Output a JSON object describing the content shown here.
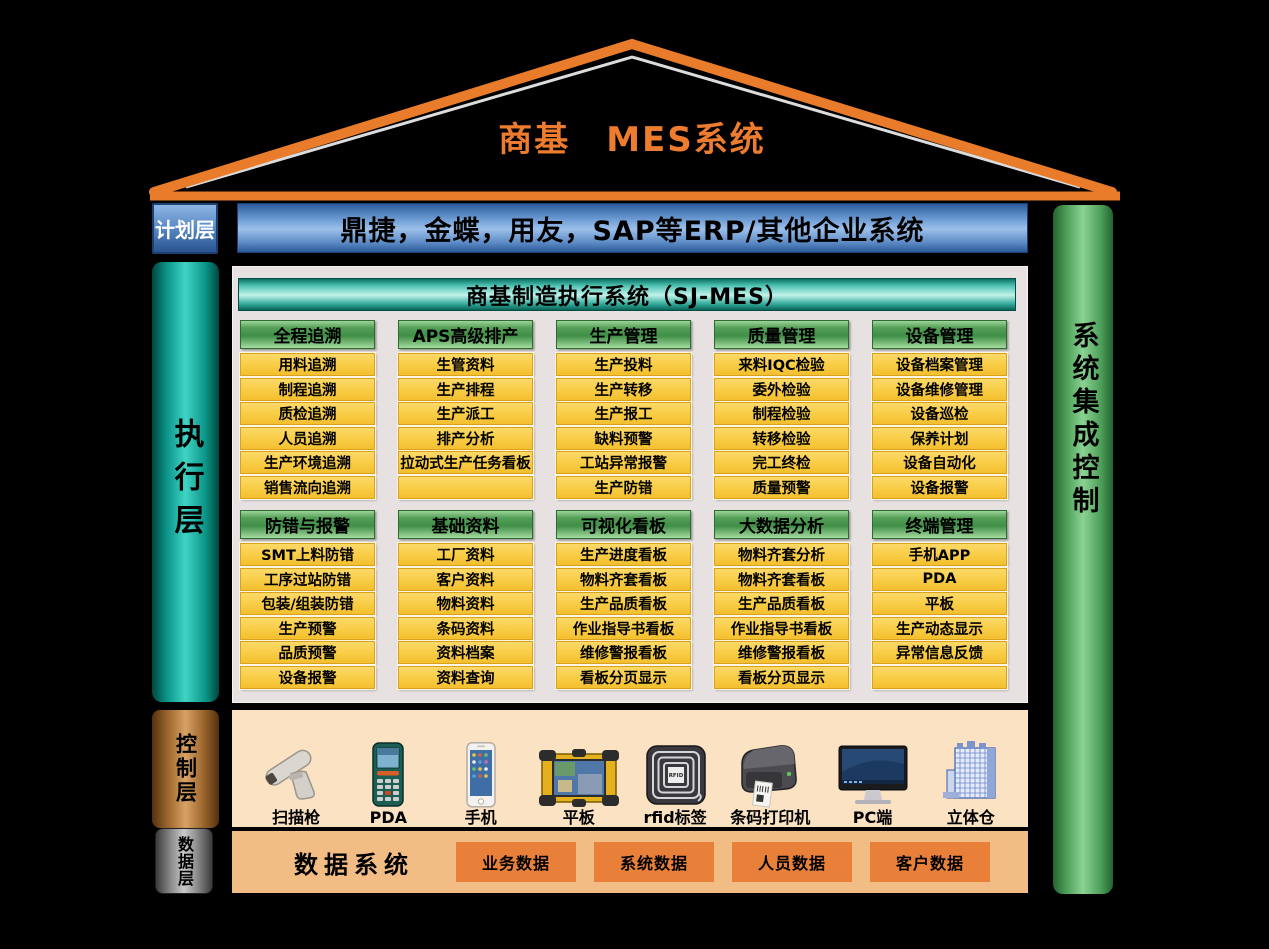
{
  "colors": {
    "roof_orange": "#e87c2a",
    "title_orange": "#ed7c2f",
    "erp_blue": "#5d8cc6",
    "execution_teal": "#3fd4c4",
    "module_header_green": "#3f8f46",
    "module_item_yellow": "#f8cc45",
    "control_copper": "#d8a265",
    "control_panel_peach": "#fbe2c3",
    "data_panel_orange": "#f2bc85",
    "data_box_orange": "#e8803a",
    "integration_green": "#8bd393"
  },
  "roof": {
    "title": "商基　MES系统"
  },
  "layers": {
    "planning": {
      "label": "计划层",
      "erp_bar": "鼎捷，金蝶，用友，SAP等ERP/其他企业系统"
    },
    "execution": {
      "label": "执行层"
    },
    "control": {
      "label": "控制层"
    },
    "data": {
      "label": "数据层"
    }
  },
  "right_bar": {
    "label": "系统集成控制"
  },
  "mes": {
    "header": "商基制造执行系统（SJ-MES）",
    "group_rows": [
      [
        {
          "title": "全程追溯",
          "items": [
            "用料追溯",
            "制程追溯",
            "质检追溯",
            "人员追溯",
            "生产环境追溯",
            "销售流向追溯"
          ]
        },
        {
          "title": "APS高级排产",
          "items": [
            "生管资料",
            "生产排程",
            "生产派工",
            "排产分析",
            "拉动式生产任务看板",
            ""
          ]
        },
        {
          "title": "生产管理",
          "items": [
            "生产投料",
            "生产转移",
            "生产报工",
            "缺料预警",
            "工站异常报警",
            "生产防错"
          ]
        },
        {
          "title": "质量管理",
          "items": [
            "来料IQC检验",
            "委外检验",
            "制程检验",
            "转移检验",
            "完工终检",
            "质量预警"
          ]
        },
        {
          "title": "设备管理",
          "items": [
            "设备档案管理",
            "设备维修管理",
            "设备巡检",
            "保养计划",
            "设备自动化",
            "设备报警"
          ]
        }
      ],
      [
        {
          "title": "防错与报警",
          "items": [
            "SMT上料防错",
            "工序过站防错",
            "包装/组装防错",
            "生产预警",
            "品质预警",
            "设备报警"
          ]
        },
        {
          "title": "基础资料",
          "items": [
            "工厂资料",
            "客户资料",
            "物料资料",
            "条码资料",
            "资料档案",
            "资料查询"
          ]
        },
        {
          "title": "可视化看板",
          "items": [
            "生产进度看板",
            "物料齐套看板",
            "生产品质看板",
            "作业指导书看板",
            "维修警报看板",
            "看板分页显示"
          ]
        },
        {
          "title": "大数据分析",
          "items": [
            "物料齐套分析",
            "物料齐套看板",
            "生产品质看板",
            "作业指导书看板",
            "维修警报看板",
            "看板分页显示"
          ]
        },
        {
          "title": "终端管理",
          "items": [
            "手机APP",
            "PDA",
            "平板",
            "生产动态显示",
            "异常信息反馈",
            ""
          ]
        }
      ]
    ]
  },
  "control_panel": {
    "devices": [
      {
        "icon": "scanner-gun-icon",
        "label": "扫描枪"
      },
      {
        "icon": "pda-icon",
        "label": "PDA"
      },
      {
        "icon": "smartphone-icon",
        "label": "手机"
      },
      {
        "icon": "rugged-tablet-icon",
        "label": "平板"
      },
      {
        "icon": "rfid-tag-icon",
        "label": "rfid标签"
      },
      {
        "icon": "barcode-printer-icon",
        "label": "条码打印机"
      },
      {
        "icon": "pc-monitor-icon",
        "label": "PC端"
      },
      {
        "icon": "warehouse-icon",
        "label": "立体仓"
      }
    ]
  },
  "data_panel": {
    "title": "数据系统",
    "boxes": [
      "业务数据",
      "系统数据",
      "人员数据",
      "客户数据"
    ]
  }
}
